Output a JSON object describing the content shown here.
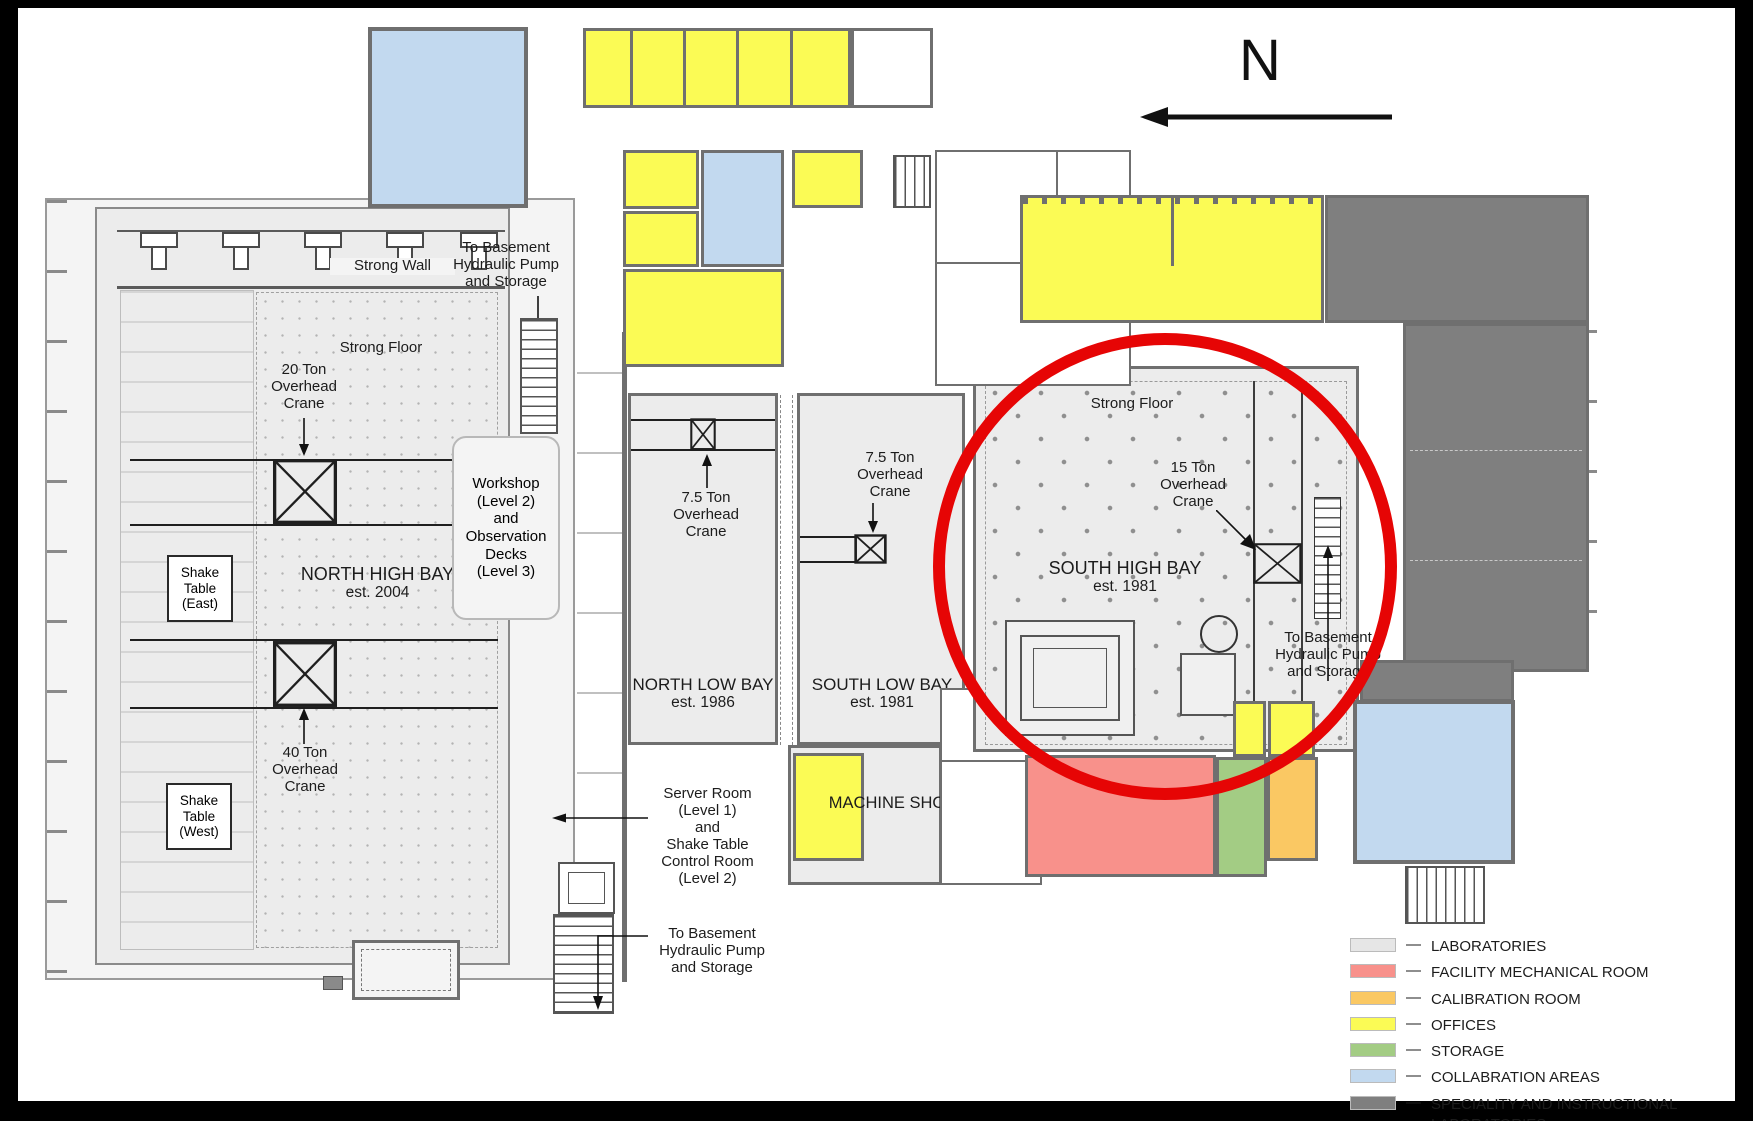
{
  "north_indicator": {
    "label": "N"
  },
  "rooms": {
    "north_high_bay": {
      "name": "NORTH HIGH BAY",
      "established": "est. 2004"
    },
    "north_low_bay": {
      "name": "NORTH LOW BAY",
      "established": "est. 1986"
    },
    "south_low_bay": {
      "name": "SOUTH LOW BAY",
      "established": "est. 1981"
    },
    "south_high_bay": {
      "name": "SOUTH HIGH BAY",
      "established": "est. 1981"
    },
    "machine_shop": {
      "name": "MACHINE SHOP"
    }
  },
  "features": {
    "strong_wall": "Strong Wall",
    "strong_floor_north": "Strong Floor",
    "strong_floor_south": "Strong Floor",
    "shake_table_east": "Shake\nTable\n(East)",
    "shake_table_west": "Shake\nTable\n(West)",
    "crane_20_ton": "20 Ton\nOverhead\nCrane",
    "crane_40_ton": "40 Ton\nOverhead\nCrane",
    "crane_7_5_ton_north": "7.5 Ton\nOverhead\nCrane",
    "crane_7_5_ton_south": "7.5 Ton\nOverhead\nCrane",
    "crane_15_ton": "15 Ton\nOverhead\nCrane",
    "workshop": "Workshop\n(Level 2)\nand\nObservation\nDecks\n(Level 3)",
    "server_room": "Server Room\n(Level 1)\nand\nShake Table\nControl Room\n(Level 2)",
    "to_basement_north": "To Basement\nHydraulic Pump\nand Storage",
    "to_basement_south": "To Basement\nHydraulic Pump\nand Storage",
    "to_basement_east": "To Basement\nHydraulic Pump\nand Storage"
  },
  "legend": {
    "separator": "—",
    "items": [
      {
        "label": "LABORATORIES",
        "color": "#e6e6e6"
      },
      {
        "label": "FACILITY MECHANICAL ROOM",
        "color": "#f8918b"
      },
      {
        "label": "CALIBRATION ROOM",
        "color": "#fac863"
      },
      {
        "label": "OFFICES",
        "color": "#fbfb55"
      },
      {
        "label": "STORAGE",
        "color": "#a3cc84"
      },
      {
        "label": "COLLABRATION AREAS",
        "color": "#c2d9ef"
      },
      {
        "label": "SPECIALITY AND INSTRUCTIONAL\nLABORATORIES",
        "color": "#7f7f7f"
      }
    ]
  },
  "annotation": {
    "highlight_circle_color": "#e60505"
  }
}
